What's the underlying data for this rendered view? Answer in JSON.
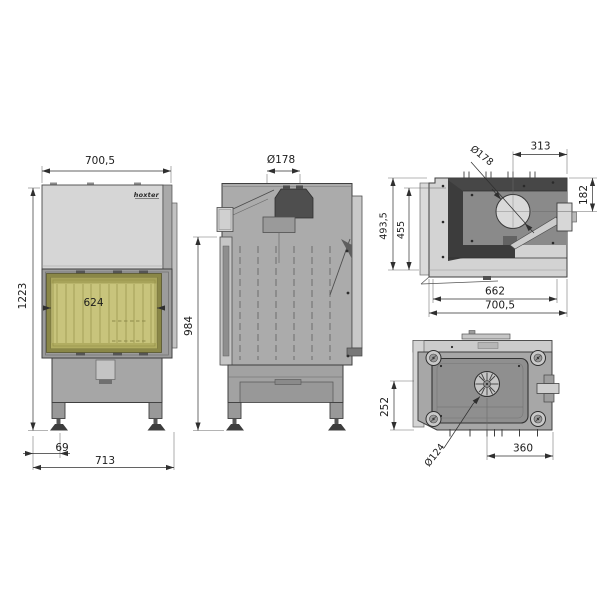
{
  "brand": {
    "logo_text": "hoxter"
  },
  "views": {
    "front": {
      "dim_width_top": "700,5",
      "dim_height": "1223",
      "dim_glass_width": "624",
      "dim_leg_offset": "69",
      "dim_width_bottom": "713"
    },
    "side": {
      "dim_flue_diameter": "Ø178",
      "dim_height": "984"
    },
    "top": {
      "dim_flue_diameter": "Ø178",
      "dim_flue_to_right": "313",
      "dim_flue_to_back": "182",
      "dim_depth_total": "493,5",
      "dim_depth_body": "455",
      "dim_width_inner": "662",
      "dim_width_total": "700,5"
    },
    "bottom": {
      "dim_fan_diameter": "Ø124",
      "dim_fan_to_right": "360",
      "dim_fan_to_front": "252"
    }
  },
  "colors": {
    "line": "#2f2f2f",
    "panel_light": "#d6d6d6",
    "body_gray": "#a9a9a9",
    "glass_yellow": "#c8c47c",
    "glass_border_olive": "#8a8747",
    "dark_fill": "#474747",
    "background": "#ffffff"
  }
}
